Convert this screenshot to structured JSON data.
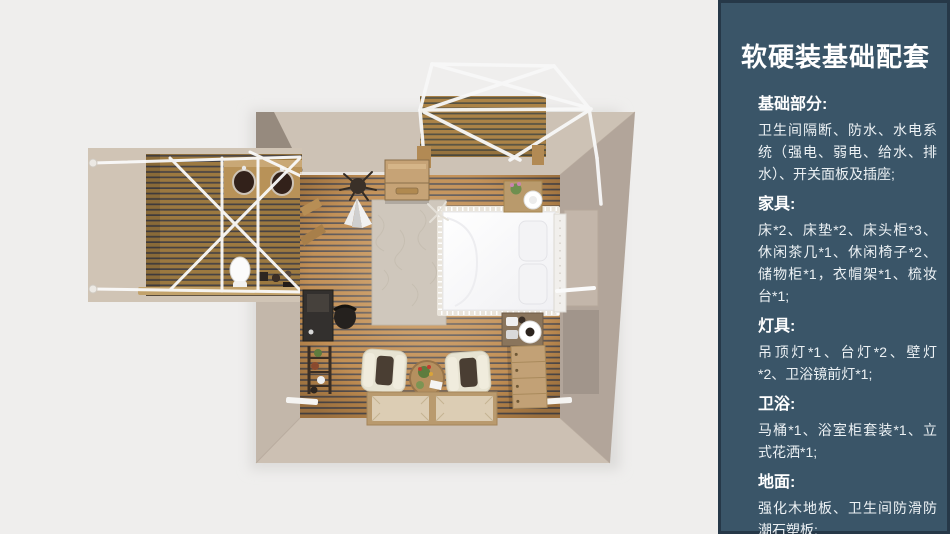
{
  "panel": {
    "title": "软硬装基础配套",
    "bg_color": "#3a5568",
    "border_color": "#263848",
    "text_color": "#ffffff",
    "sections": [
      {
        "id": "basics",
        "heading": "基础部分:",
        "body": "卫生间隔断、防水、水电系统（强电、弱电、给水、排水）、开关面板及插座;"
      },
      {
        "id": "furniture",
        "heading": "家具:",
        "body": "床*2、床垫*2、床头柜*3、休闲茶几*1、休闲椅子*2、储物柜*1，衣帽架*1、梳妆台*1;"
      },
      {
        "id": "lighting",
        "heading": "灯具:",
        "body": "吊顶灯*1、台灯*2、壁灯*2、卫浴镜前灯*1;"
      },
      {
        "id": "bath",
        "heading": "卫浴:",
        "body": "马桶*1、浴室柜套装*1、立式花洒*1;"
      },
      {
        "id": "flooring",
        "heading": "地面:",
        "body": "强化木地板、卫生间防滑防潮石塑板;"
      }
    ]
  },
  "floorplan": {
    "type": "top-down 3D bedroom render with bathroom wing and canopy deck",
    "colors": {
      "background": "#efeeed",
      "wall": "#cdc2b5",
      "wall_shadow": "#968a7e",
      "floor_plank": "#bf8a4d",
      "floor_gap": "#564f4e",
      "wing_plank": "#9c7940",
      "deck_plank": "#ab8347",
      "frame_white": "#f8f8f8",
      "bed_white": "#fcfcfd",
      "furniture_wood": "#c2a176"
    },
    "items": [
      "canopy-deck",
      "canopy-frame",
      "bathroom-wing",
      "double-sink-counter",
      "toilet",
      "bed",
      "headboard",
      "nightstand-top",
      "nightstand-bottom",
      "rug",
      "storage-chest",
      "armchair-left",
      "armchair-right",
      "tea-table",
      "tatami-mats",
      "dresser",
      "desk",
      "desk-chair",
      "ladder-shelf",
      "coat-rack",
      "plant",
      "wall-mirror"
    ]
  }
}
